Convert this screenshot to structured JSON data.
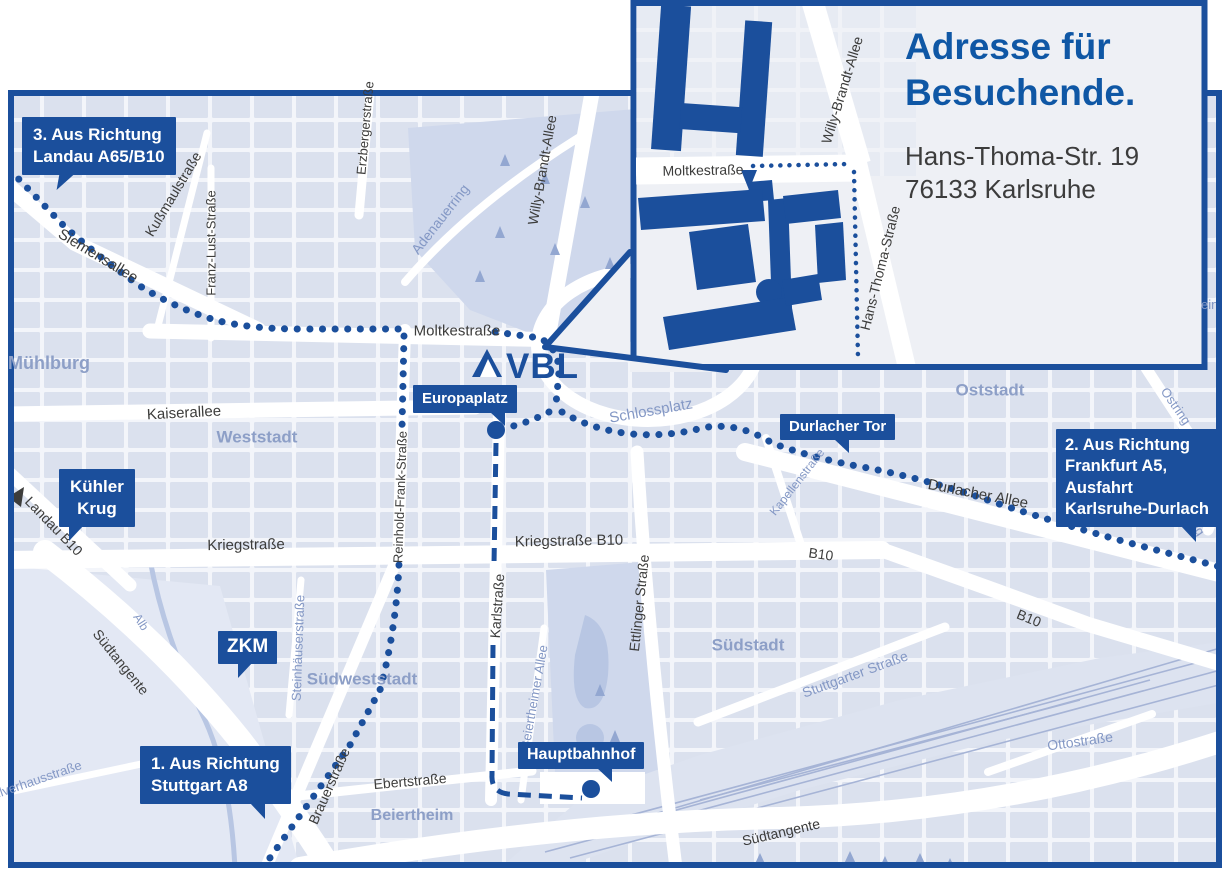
{
  "colors": {
    "brand_blue": "#1b4f9c",
    "title_blue": "#0f57a5",
    "map_background": "#f3f5fa",
    "block_fill": "#dbe1ee",
    "park_fill": "#cfd8ec",
    "district_label": "#8d9fc7",
    "street_label_dark": "#3c3c3b",
    "street_label_blue": "#8498c5",
    "address_text": "#3c3c3c"
  },
  "logo": {
    "text": "VBL"
  },
  "icons": {
    "landau_arrow": "◀"
  },
  "inset": {
    "title_line1": "Adresse für",
    "title_line2": "Besuchende.",
    "address_line1": "Hans-Thoma-Str. 19",
    "address_line2": "76133 Karlsruhe",
    "streets": {
      "moltkestrasse": "Moltkestraße",
      "willy_brandt_allee": "Willy-Brandt-Allee",
      "hans_thoma_strasse": "Hans-Thoma-Straße"
    }
  },
  "callouts": {
    "route3_line1": "3. Aus Richtung",
    "route3_line2": "Landau A65/B10",
    "route2_line1": "2. Aus Richtung",
    "route2_line2": "Frankfurt A5,",
    "route2_line3": "Ausfahrt",
    "route2_line4": "Karlsruhe-Durlach",
    "route1_line1": "1. Aus Richtung",
    "route1_line2": "Stuttgart A8",
    "kuehler_krug_line1": "Kühler",
    "kuehler_krug_line2": "Krug",
    "europaplatz": "Europaplatz",
    "zkm": "ZKM",
    "durlacher_tor": "Durlacher Tor",
    "hauptbahnhof": "Hauptbahnhof"
  },
  "streets": {
    "siemensallee": "Siemensallee",
    "kussmaulstrasse": "Kußmaulstraße",
    "franz_lust_strasse": "Franz-Lust-Straße",
    "erzbergerstrasse": "Erzbergerstraße",
    "adenauerring": "Adenauerring",
    "willy_brandt_allee": "Willy-Brandt-Allee",
    "moltkestrasse": "Moltkestraße",
    "kaiserallee": "Kaiserallee",
    "reinhold_frank_strasse": "Reinhold-Frank-Straße",
    "kriegstrasse": "Kriegstraße",
    "kriegstrasse_b10": "Kriegstraße B10",
    "karlstrasse": "Karlstraße",
    "ettlinger_strasse": "Ettlinger Straße",
    "steinhaeuserstrasse": "Steinhäuserstraße",
    "beiertheimer_allee": "Beiertheimer Allee",
    "ebertstrasse": "Ebertstraße",
    "brauerstrasse": "Brauerstraße",
    "schlossplatz": "Schlossplatz",
    "kapellenstrasse": "Kapellenstraße",
    "durlacher_allee": "Durlacher Allee",
    "b10_center": "B10",
    "b10_east": "B10",
    "stuttgarter_strasse": "Stuttgarter Straße",
    "ottostrasse": "Ottostraße",
    "suedtangente_west": "Südtangente",
    "suedtangente_south": "Südtangente",
    "alb": "Alb",
    "pulverhausstrasse": "Pulverhausstraße",
    "landau_b10": "Landau B10",
    "ostring_north": "Ostring",
    "ostring_south": "Ostring",
    "edge_fragment": "ein"
  },
  "districts": {
    "muehlburg": "Mühlburg",
    "weststadt": "Weststadt",
    "suedweststadt": "Südweststadt",
    "suedstadt": "Südstadt",
    "oststadt": "Oststadt",
    "beiertheim": "Beiertheim"
  }
}
